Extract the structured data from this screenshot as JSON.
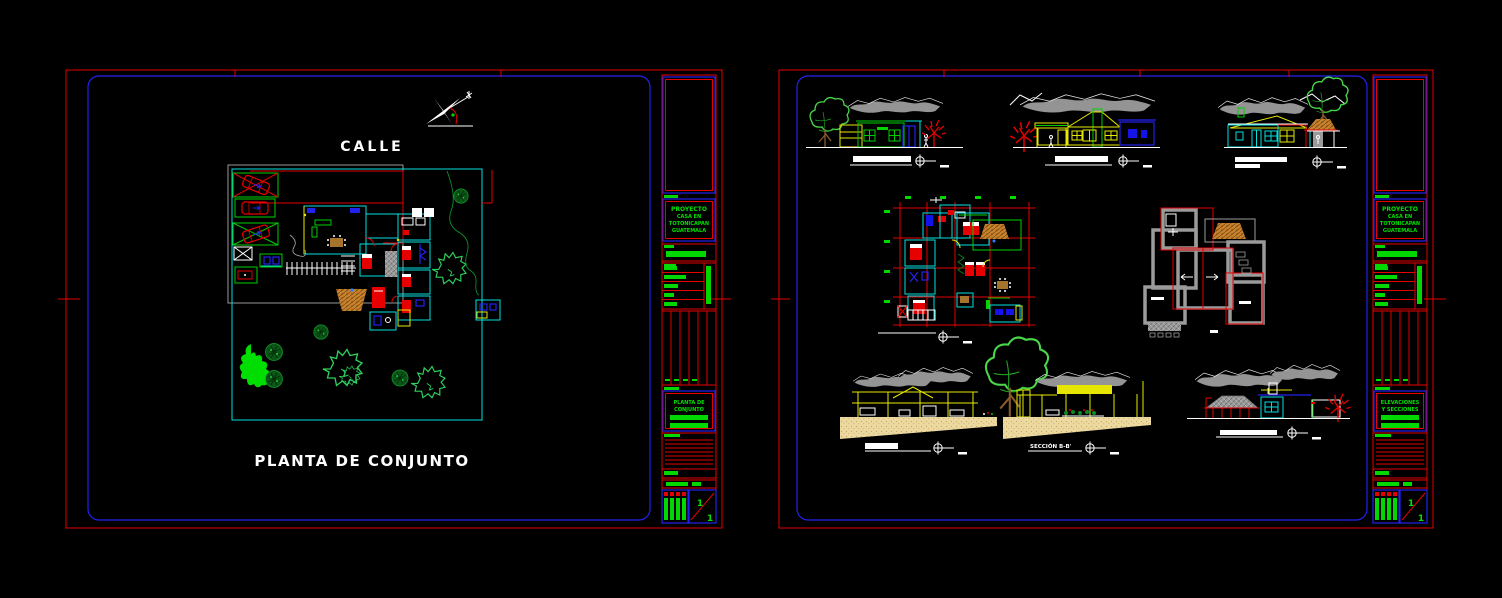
{
  "palette": {
    "background": "#000000",
    "border_red": "#e60000",
    "border_blue": "#2222ee",
    "cad_cyan": "#00e0e0",
    "cad_green": "#00d000",
    "cad_yellow": "#e8e800",
    "cad_gray": "#9b9b9b",
    "terrain_tan": "#ecd9a0",
    "roof_orange": "#c8822d",
    "text_white": "#ffffff",
    "titleblock_green": "#00e000"
  },
  "left_sheet": {
    "street_label": "CALLE",
    "drawing_title": "PLANTA DE CONJUNTO",
    "title_block": {
      "project_lines": [
        "PROYECTO",
        "CASA EN",
        "TOTONICAPAN",
        "GUATEMALA"
      ],
      "drawing_lines": [
        "PLANTA DE",
        "CONJUNTO"
      ],
      "sheet_top": "1",
      "sheet_bottom": "1"
    }
  },
  "right_sheet": {
    "section_label": "SECCIÓN B-B'",
    "title_block": {
      "project_lines": [
        "PROYECTO",
        "CASA EN",
        "TOTONICAPAN",
        "GUATEMALA"
      ],
      "drawing_lines": [
        "ELEVACIONES",
        "Y SECCIONES"
      ],
      "sheet_top": "1",
      "sheet_bottom": "1"
    }
  }
}
